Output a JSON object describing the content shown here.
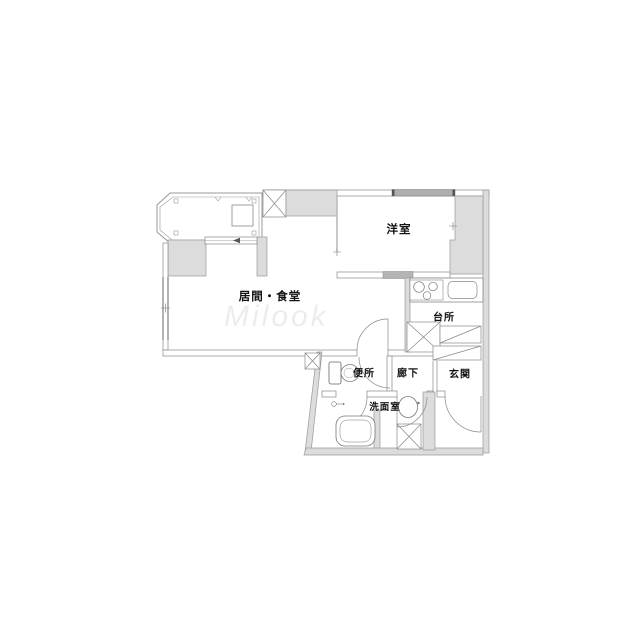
{
  "plan": {
    "type": "apartment-floor-plan",
    "rooms": {
      "living_dining": {
        "label": "居間・食堂"
      },
      "western_room": {
        "label": "洋室"
      },
      "kitchen": {
        "label": "台所"
      },
      "hallway": {
        "label": "廊下"
      },
      "entrance": {
        "label": "玄関"
      },
      "toilet": {
        "label": "便所"
      },
      "washroom": {
        "label": "洗面室"
      }
    },
    "fixtures": [
      "balcony-railing",
      "sliding-door",
      "pipe-shaft-x-box",
      "closet",
      "stove-3-burners",
      "kitchen-sink",
      "refrigerator-space-x-box",
      "shoe-cabinet-hatched",
      "toilet-fixture",
      "bathtub",
      "washbasin",
      "washing-machine-pan-x-box",
      "door-swing-arcs",
      "entry-step-kamachi"
    ],
    "watermark": "Milook",
    "colors": {
      "background": "#ffffff",
      "wall_fill": "#dcdcdc",
      "wall_stroke": "#999999",
      "line": "#8a8a8a",
      "window_fill": "#aeaeae",
      "label_text": "#111111"
    }
  }
}
